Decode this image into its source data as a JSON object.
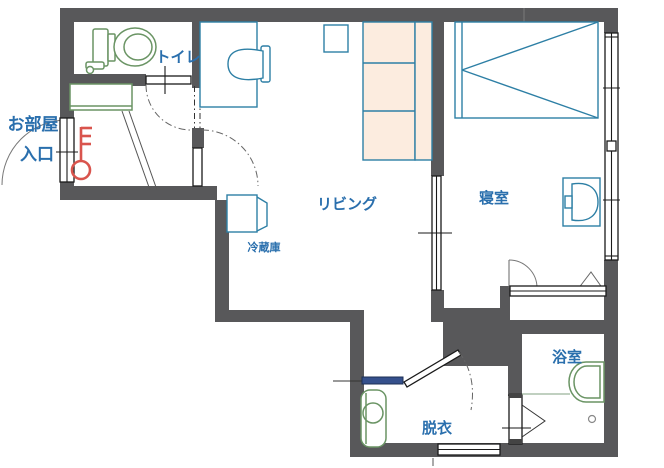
{
  "plan": {
    "rooms": {
      "toilet": "トイレ",
      "entrance_line1": "お部屋",
      "entrance_line2": "入口",
      "living": "リビング",
      "bedroom": "寝室",
      "dressing": "脱衣",
      "bathroom": "浴室"
    },
    "appliances": {
      "fridge": "冷蔵庫"
    },
    "colors": {
      "wall": "#58585a",
      "furniture_line": "#2d7fa5",
      "fixture_line": "#6a9464",
      "kitchen_fill": "#fcecdf",
      "label_text": "#2a6fad",
      "key_icon": "#d9544d",
      "sliding_rail": "#35508c"
    }
  }
}
